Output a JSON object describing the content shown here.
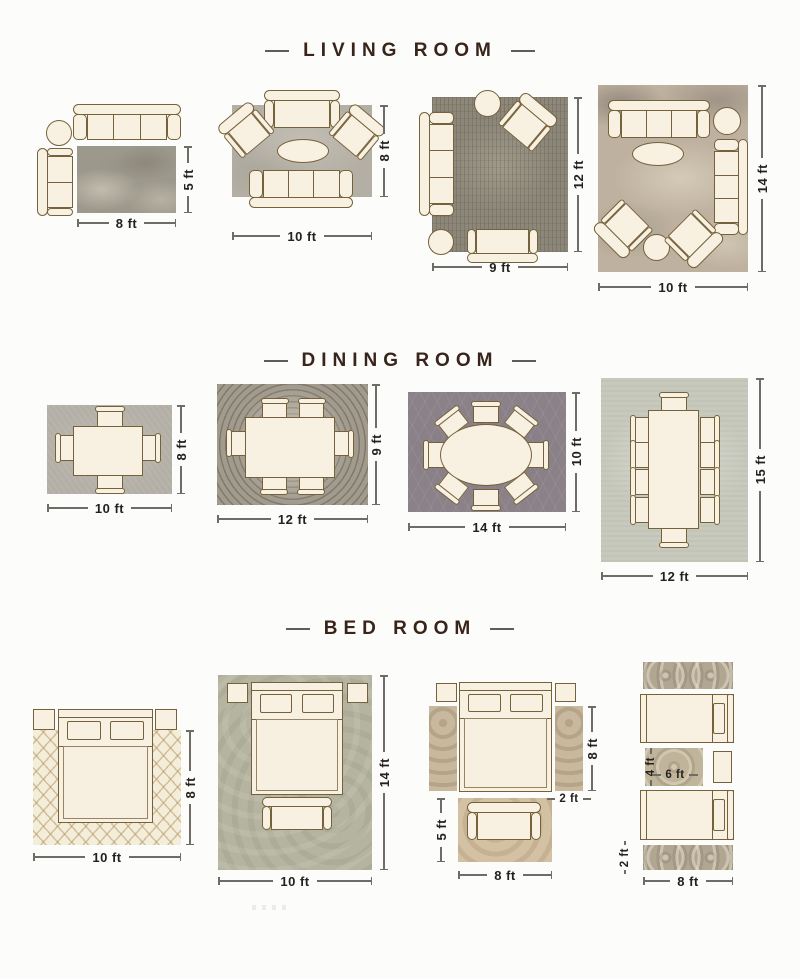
{
  "sections": [
    {
      "title": "LIVING ROOM",
      "layouts": [
        {
          "width_label": "8 ft",
          "height_label": "5 ft"
        },
        {
          "width_label": "10 ft",
          "height_label": "8 ft"
        },
        {
          "width_label": "9 ft",
          "height_label": "12 ft"
        },
        {
          "width_label": "10 ft",
          "height_label": "14 ft"
        }
      ]
    },
    {
      "title": "DINING ROOM",
      "layouts": [
        {
          "width_label": "10 ft",
          "height_label": "8 ft"
        },
        {
          "width_label": "12 ft",
          "height_label": "9 ft"
        },
        {
          "width_label": "14 ft",
          "height_label": "10 ft"
        },
        {
          "width_label": "12 ft",
          "height_label": "15 ft"
        }
      ]
    },
    {
      "title": "BED ROOM",
      "layouts": [
        {
          "width_label": "10 ft",
          "height_label": "8 ft"
        },
        {
          "width_label": "10 ft",
          "height_label": "14 ft"
        },
        {
          "bed_height_label": "8 ft",
          "runner_width_label": "2 ft",
          "foot_rug_height_label": "5 ft",
          "foot_rug_width_label": "8 ft"
        },
        {
          "between_rug_height_label": "4 ft",
          "between_rug_width_label": "6 ft",
          "runner_height_label": "2 ft",
          "runner_width_label": "8 ft"
        }
      ]
    }
  ],
  "colors": {
    "background": "#fcfcfa",
    "furniture_fill": "#f8f1e2",
    "furniture_outline": "#75613a",
    "title_text": "#38241a",
    "dimension_text": "#24211e",
    "dimension_line": "#6f6b66",
    "living_rug_1": "#9c988b",
    "living_rug_2": "#b4afa4",
    "living_rug_3": "#8d8779",
    "living_rug_4": "#beb19f",
    "dining_rug_1": "#b3afa6",
    "dining_rug_2": "#a19a8d",
    "dining_rug_3": "#8b8189",
    "dining_rug_4": "#c7c9bd",
    "bed_rug_1": "#f4edda",
    "bed_rug_2": "#b5b4a1",
    "bed_rug_3_runner": "#c8b89d",
    "bed_rug_3_foot": "#d3c1a3",
    "bed_rug_4": "#b1a692"
  }
}
